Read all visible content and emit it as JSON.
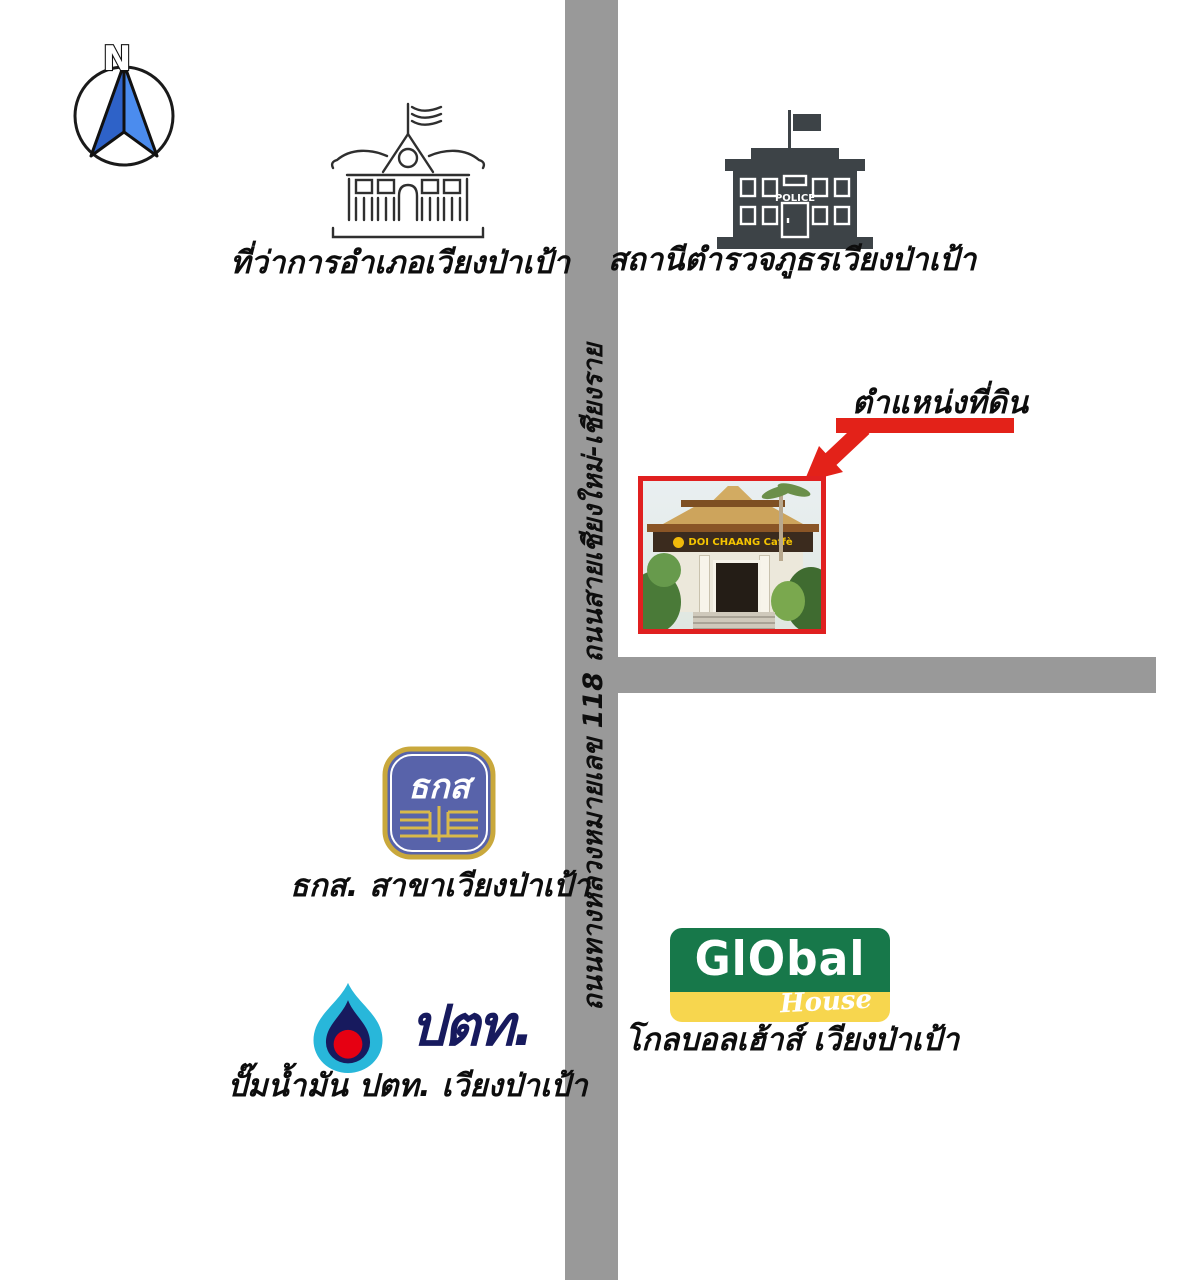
{
  "compass": {
    "label": "N"
  },
  "roads": {
    "highway_label": "ถนนทางหลวงหมายเลข 118 ถนนสายเชียงใหม่-เชียงราย",
    "color": "#999999"
  },
  "landmarks": {
    "district_office": {
      "label": "ที่ว่าการอำเภอเวียงป่าเป้า"
    },
    "police_station": {
      "label": "สถานีตำรวจภูธรเวียงป่าเป้า",
      "sign": "POLICE"
    },
    "land_plot": {
      "label": "ตำแหน่งที่ดิน",
      "photo_sign": "DOI CHAANG Caffè"
    },
    "baac": {
      "label": "ธกส. สาขาเวียงป่าเป้า",
      "emblem": "ธกส"
    },
    "ptt": {
      "label": "ปั๊มน้ำมัน ปตท. เวียงป่าเป้า",
      "logo_text": "ปตท."
    },
    "global_house": {
      "label": "โกลบอลเฮ้าส์ เวียงป่าเป้า",
      "logo_text": "GlObal",
      "logo_subtext": "House"
    }
  },
  "colors": {
    "road": "#999999",
    "highlight_red": "#e02020",
    "police_gray": "#3d4347",
    "compass_blue_dark": "#2e62c8",
    "compass_blue_light": "#4b8cee",
    "baac_blue": "#5863aa",
    "baac_gold": "#c9a83c",
    "ptt_cyan": "#28b7da",
    "ptt_navy": "#171a5e",
    "ptt_red": "#e60012",
    "global_green": "#17784a",
    "global_yellow": "#f7d64e"
  }
}
